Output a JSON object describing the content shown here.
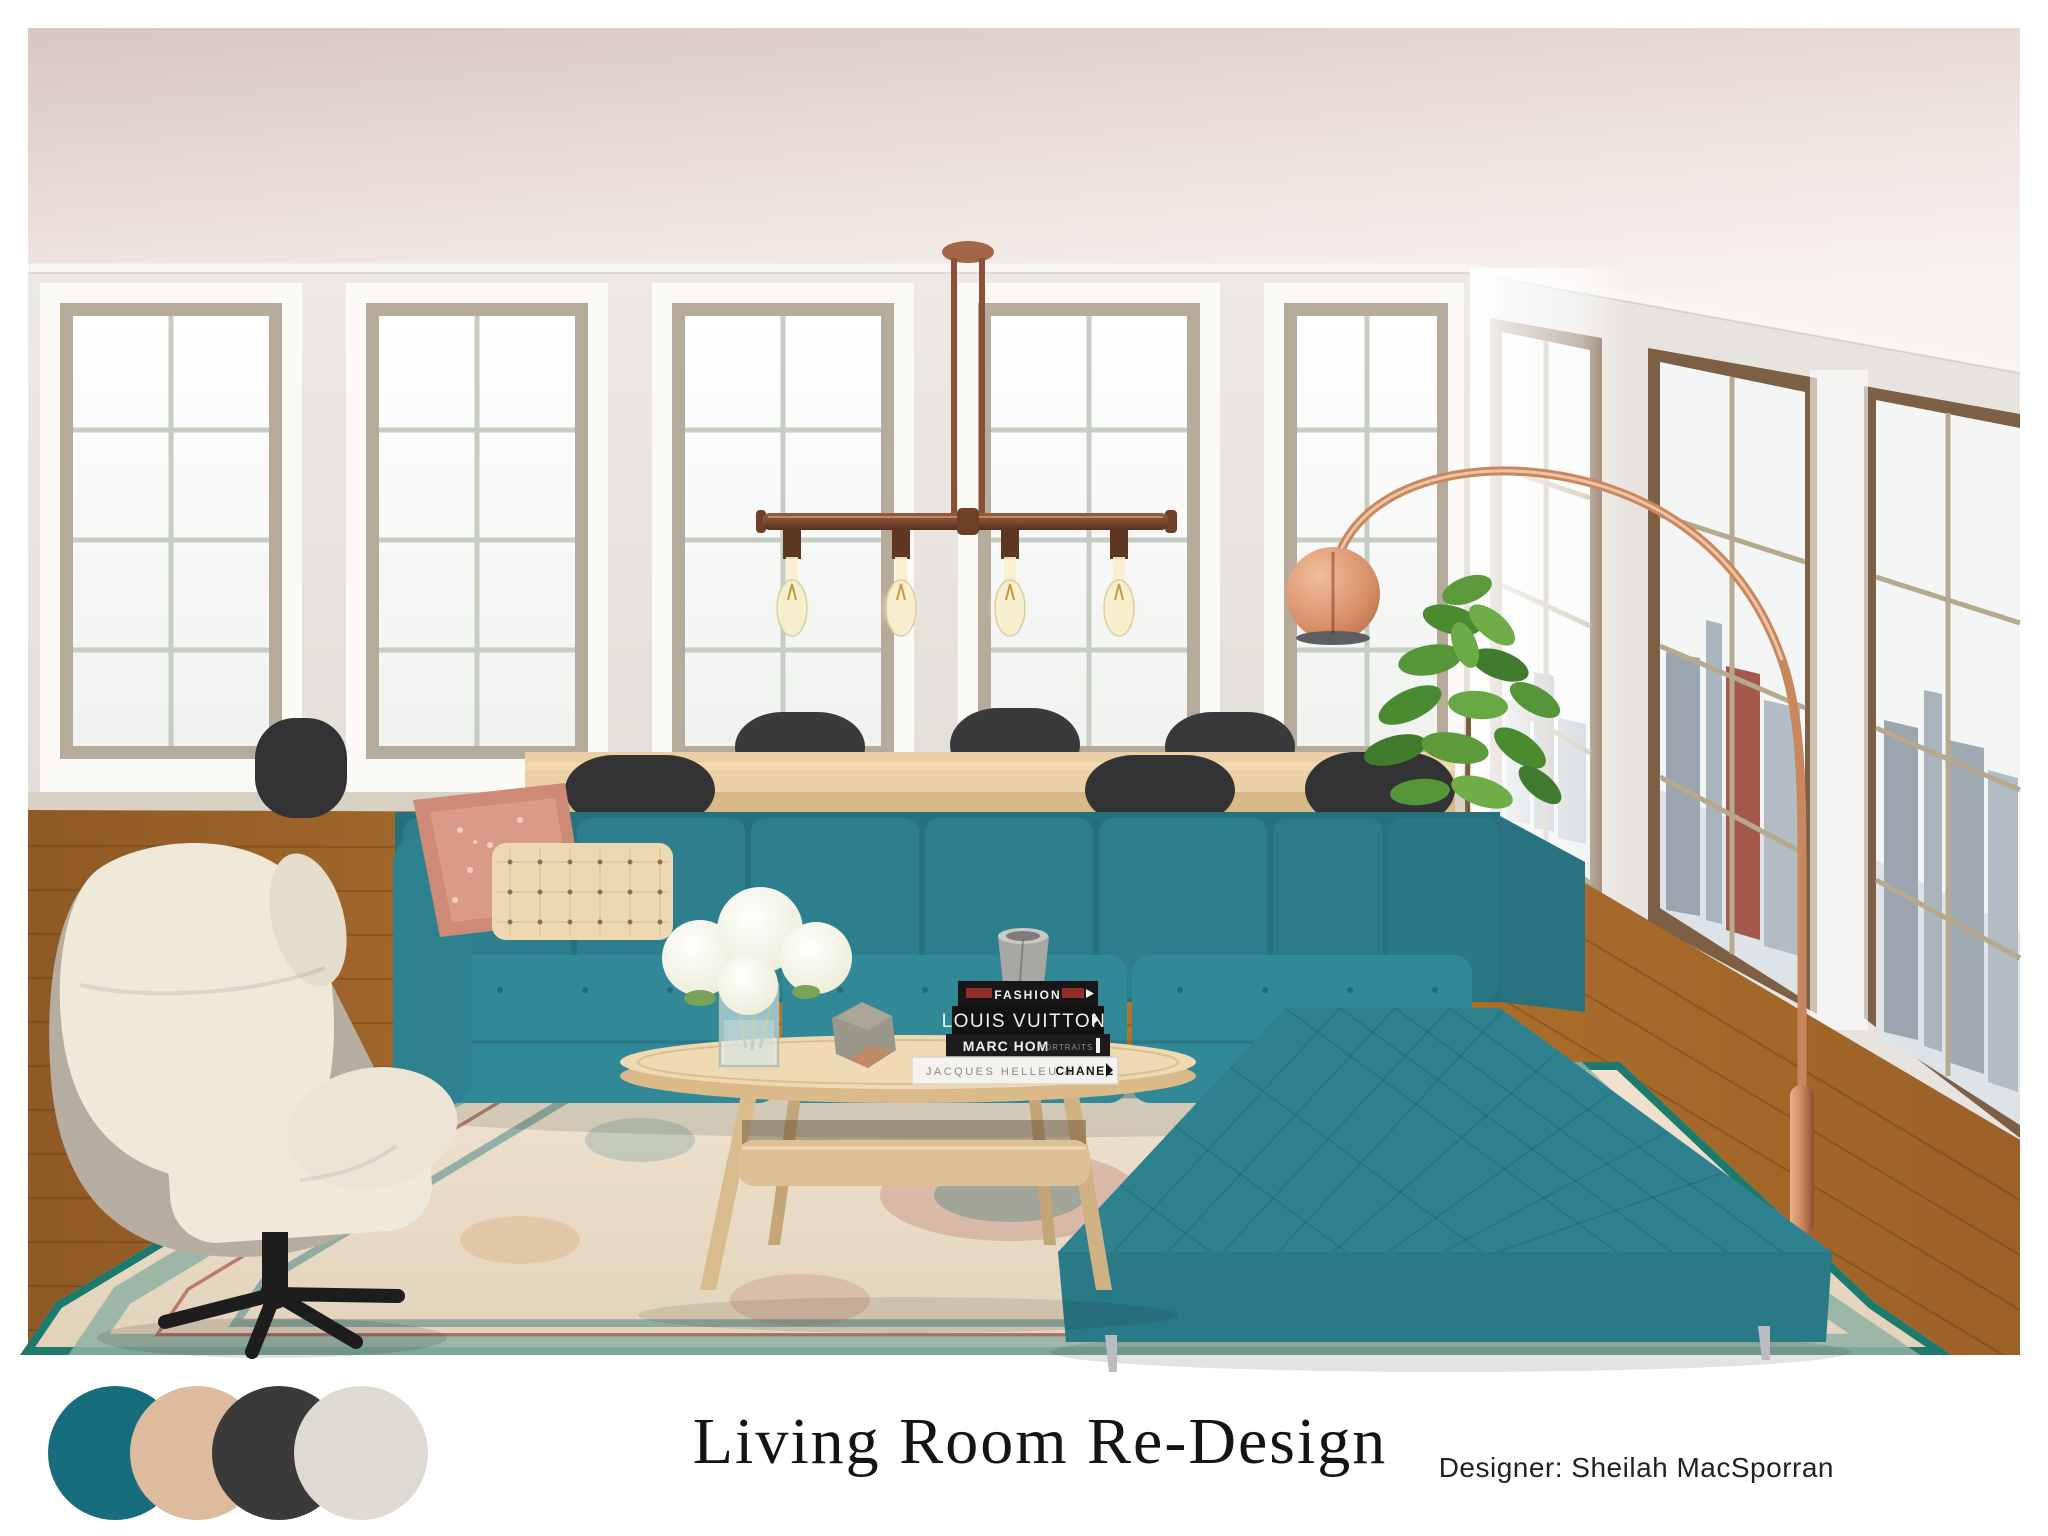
{
  "board": {
    "title": "Living Room Re-Design",
    "designer_credit": "Designer: Sheilah MacSporran"
  },
  "palette": {
    "colors": [
      {
        "label": "teal",
        "hex": "#186d7d"
      },
      {
        "label": "blush-tan",
        "hex": "#ddbb9f"
      },
      {
        "label": "charcoal",
        "hex": "#3a3a3a"
      },
      {
        "label": "ivory",
        "hex": "#dfdbd3"
      }
    ]
  },
  "books": {
    "fashion": "FASHION",
    "louis_vuitton": "LOUIS VUITTON",
    "marc_hom": "MARC HOM",
    "marc_hom_sub": "PORTRAITS",
    "helleu": "JACQUES HELLEU &",
    "chanel": "CHANEL"
  },
  "accents": {
    "sofa_teal": "#2e8290",
    "copper": "#c9875f",
    "wood_floor": "#a86b2c",
    "rug_border_teal": "#1d7a6c"
  }
}
